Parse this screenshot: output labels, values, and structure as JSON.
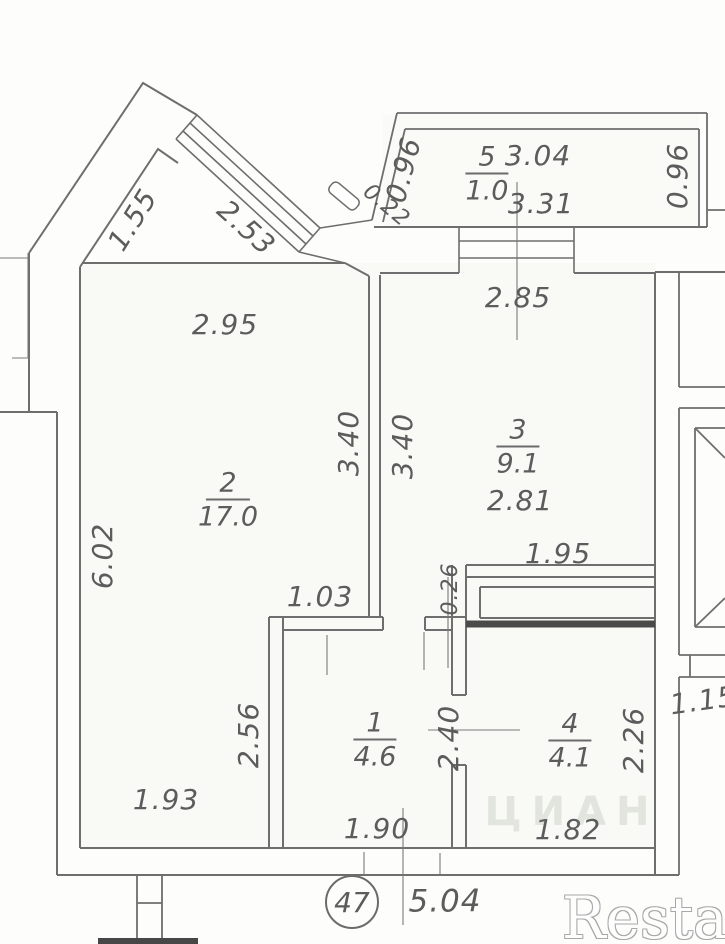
{
  "plan": {
    "apartment_number": "47",
    "rooms": [
      {
        "number": "1",
        "area": "4.6"
      },
      {
        "number": "2",
        "area": "17.0"
      },
      {
        "number": "3",
        "area": "9.1"
      },
      {
        "number": "4",
        "area": "4.1"
      },
      {
        "number": "5",
        "area": "1.0"
      }
    ],
    "dims": {
      "diag_wall": "1.55",
      "diag_window": "2.53",
      "balcony_left": "0.96",
      "balcony_corner": "0.22",
      "balcony_right": "0.96",
      "balcony_top": "3.04",
      "balcony_bottom": "3.31",
      "kitchen_top": "2.85",
      "living_top": "2.95",
      "wall_living_side": "3.40",
      "wall_kitchen_side": "3.40",
      "kitchen_width": "2.81",
      "left_wall": "6.02",
      "kitchen_bottom": "1.95",
      "duct": "0.26",
      "hall_top": "1.03",
      "hall_left": "2.56",
      "hall_wall": "2.40",
      "bath_right": "2.26",
      "right_side": "1.15",
      "living_bottom": "1.93",
      "hall_bottom": "1.90",
      "bath_bottom": "1.82",
      "total_bottom": "5.04"
    }
  },
  "watermarks": {
    "center": "ЦИАН",
    "corner": "Restate"
  },
  "colors": {
    "line": "#6e6e6e",
    "dark_wall": "#4a4a4a",
    "text": "#5c5c5c"
  }
}
